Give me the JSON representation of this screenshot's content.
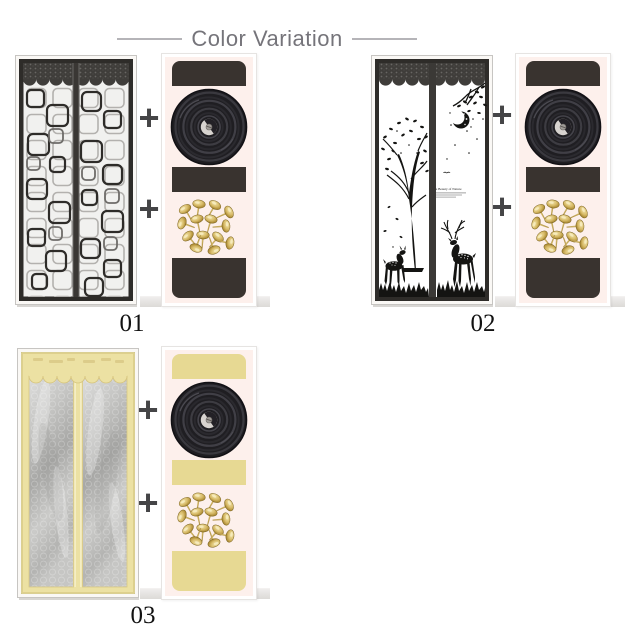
{
  "title": "Color Variation",
  "plus_symbol": "+",
  "products": [
    {
      "label": "01"
    },
    {
      "label": "02"
    },
    {
      "label": "03"
    }
  ],
  "door_print": {
    "heading": "The Beauty of Nature"
  },
  "colors": {
    "title_gray": "#75747a",
    "block_dark": "#39332f",
    "block_khaki": "#e7d993",
    "strip_bg": "#fdf0ec",
    "mesh_dark": "#2e2c29",
    "door3_khaki": "#ece1a3",
    "gold": "#c3a44e"
  }
}
